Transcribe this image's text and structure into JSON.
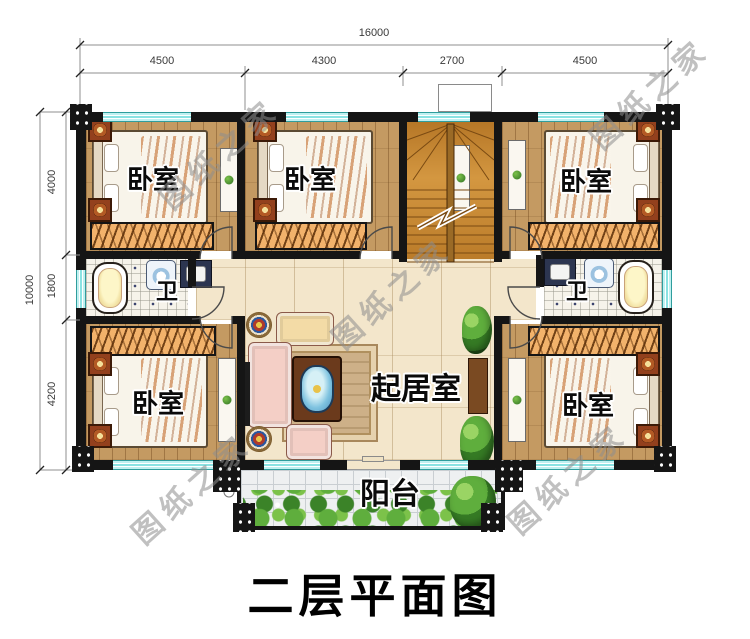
{
  "title": "二层平面图",
  "watermark_text": "图纸之家",
  "dimensions": {
    "top_total": "16000",
    "top_segments": [
      "4500",
      "4300",
      "2700",
      "4500"
    ],
    "left_total": "10000",
    "left_segments": [
      "4000",
      "1800",
      "4200"
    ]
  },
  "rooms": [
    {
      "id": "bedroom-top-left",
      "label": "卧室"
    },
    {
      "id": "bedroom-top-middle",
      "label": "卧室"
    },
    {
      "id": "bedroom-top-right",
      "label": "卧室"
    },
    {
      "id": "bathroom-left",
      "label": "卫"
    },
    {
      "id": "bathroom-right",
      "label": "卫"
    },
    {
      "id": "living-room",
      "label": "起居室"
    },
    {
      "id": "bedroom-bottom-left",
      "label": "卧室"
    },
    {
      "id": "bedroom-bottom-right",
      "label": "卧室"
    },
    {
      "id": "balcony",
      "label": "阳台"
    }
  ],
  "colors": {
    "wall": "#151515",
    "window": "#8ae2e2",
    "bedroom_floor": "#c49a62",
    "hall_floor": "#f3e6cb",
    "stair_wood": "#ca8a30",
    "bath_tile": "#f6f3ea",
    "balcony_tile": "#eef0f1",
    "wardrobe": "#f2b26b",
    "watermark": "#8e8e8e",
    "label": "#0a0a0a",
    "title": "#000000"
  }
}
